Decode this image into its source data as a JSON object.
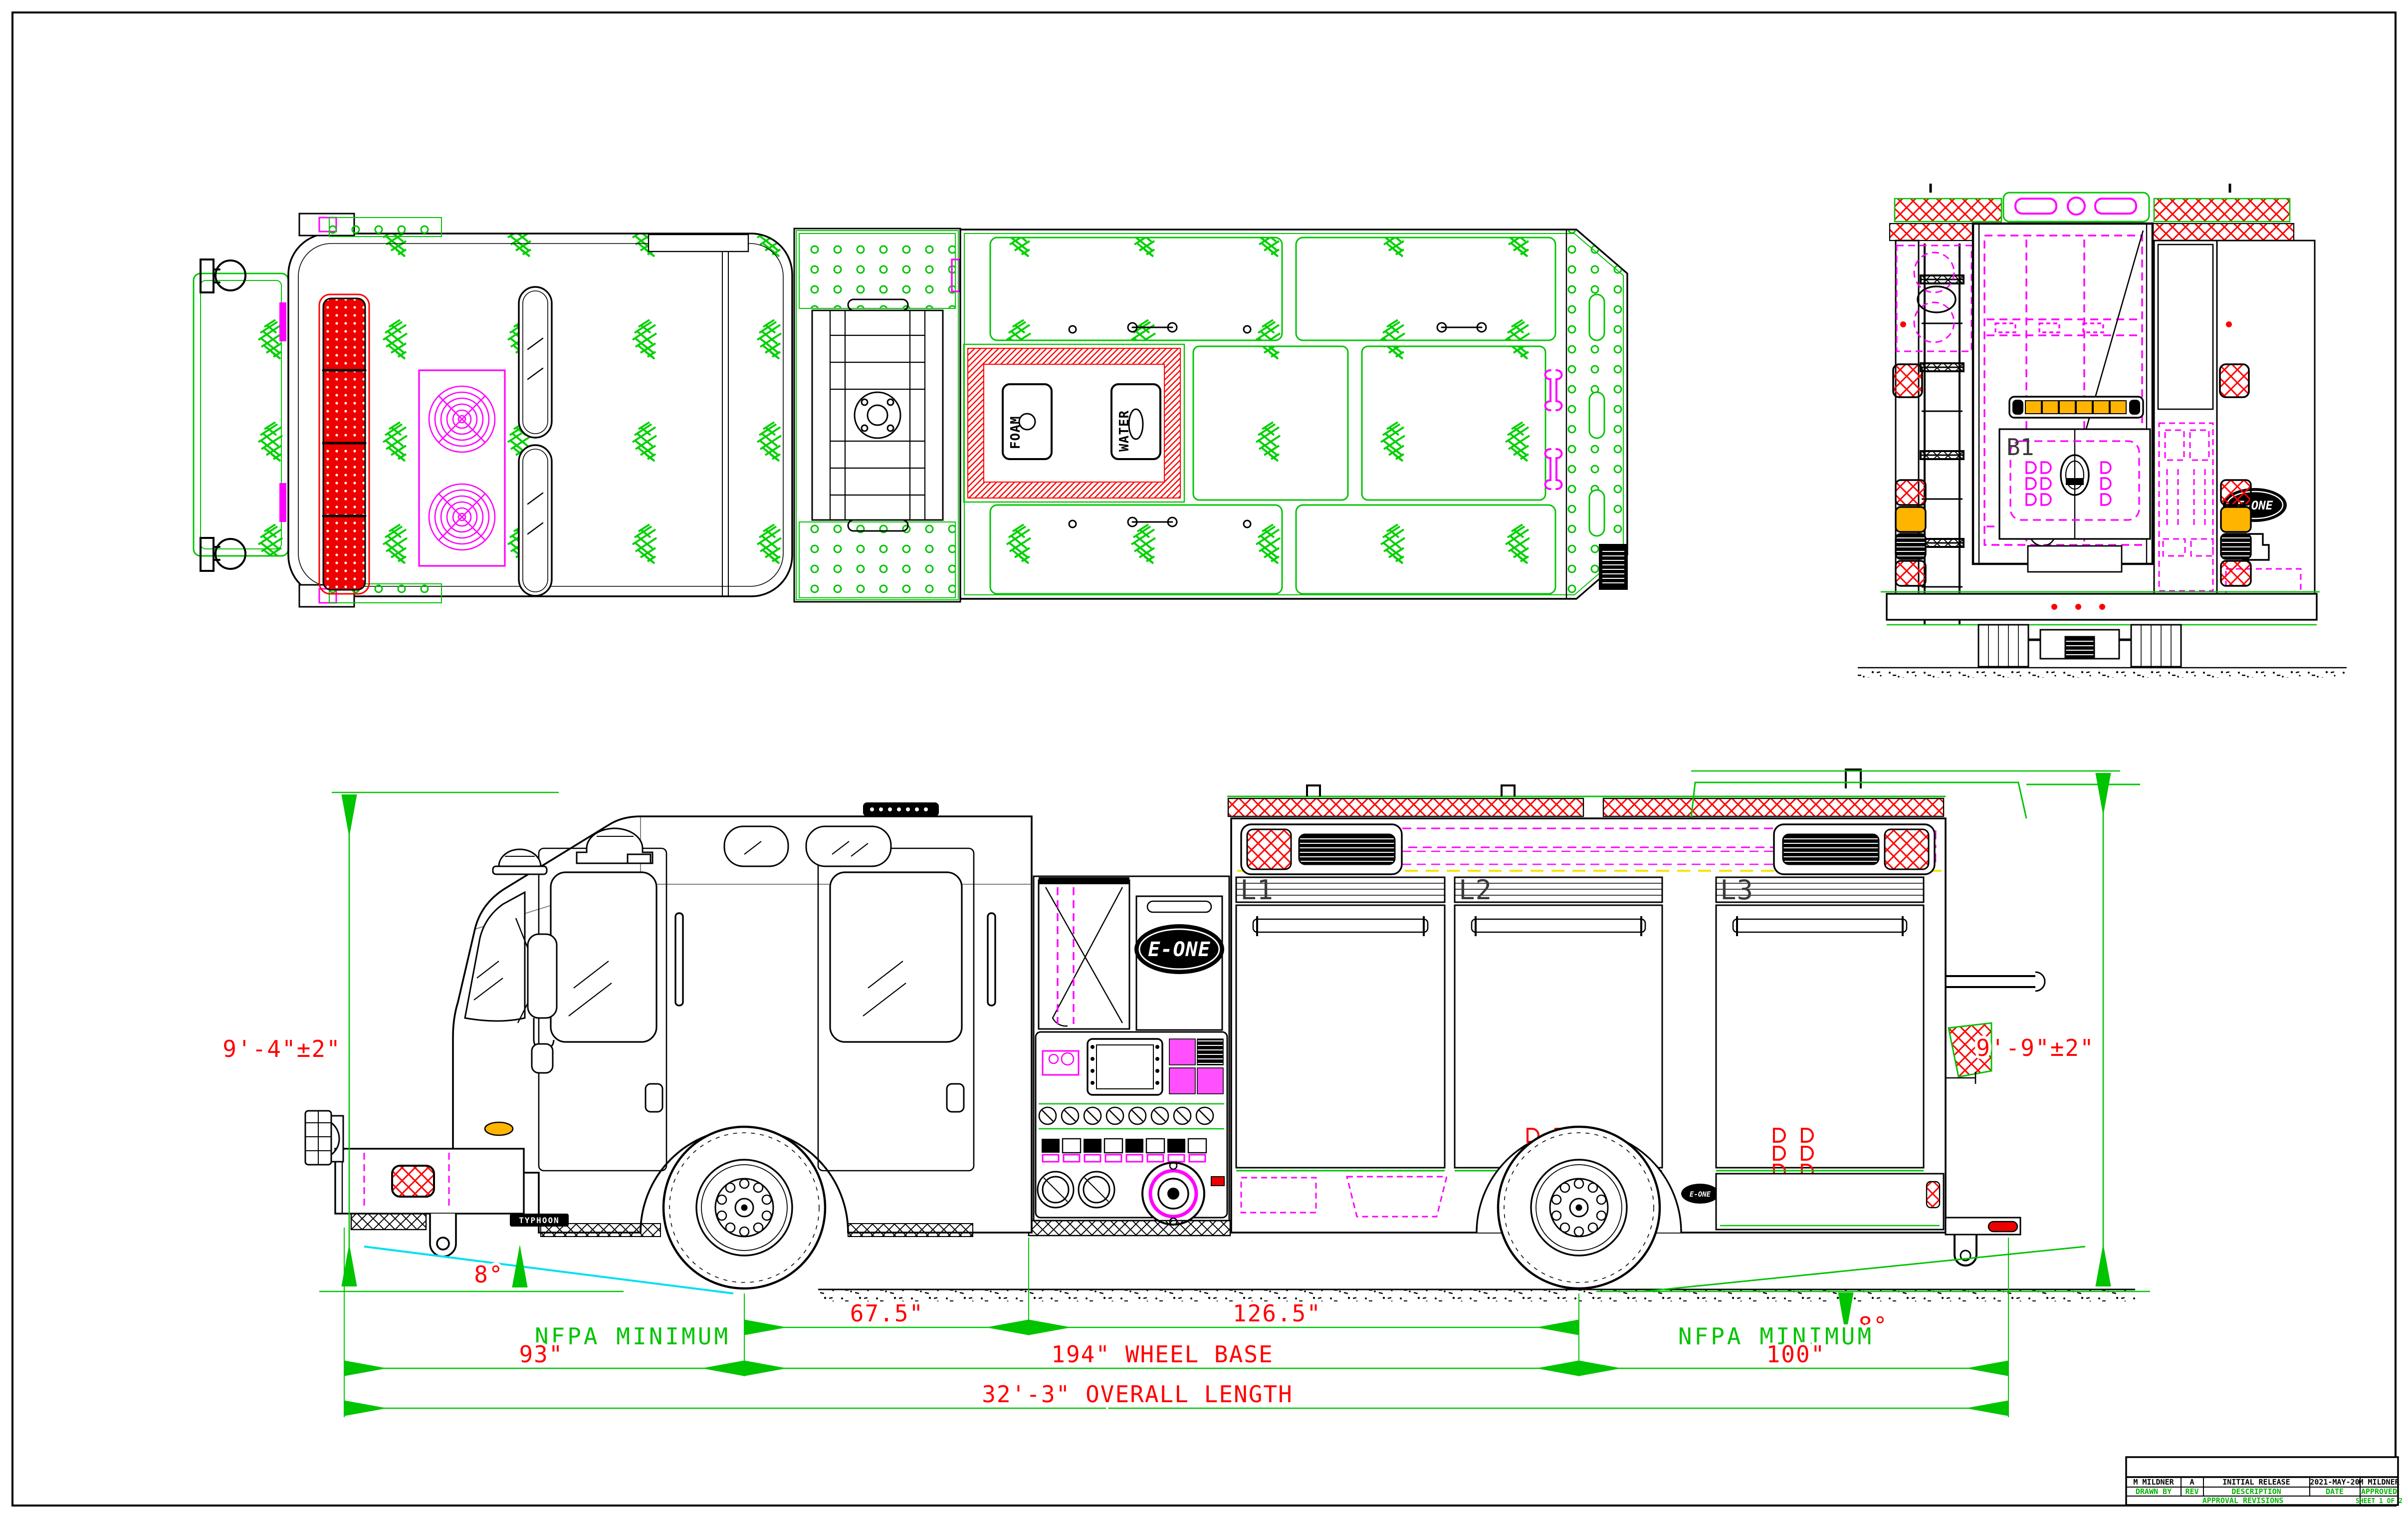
{
  "sheet": {
    "background": "#ffffff",
    "frame_color": "#000000",
    "line_color": "#000000",
    "annotation_green": "#00c400",
    "dimension_red": "#ff0000",
    "equipment_magenta": "#ff00ff",
    "angle_cyan": "#00e0f0",
    "reference_yellow": "#f5e400",
    "warning_amber": "#ffb400"
  },
  "views": {
    "top": "TOP VIEW",
    "rear": "REAR VIEW",
    "side": "SIDE VIEW"
  },
  "labels": {
    "brand": "E-ONE",
    "model": "TYPHOON",
    "door_l1": "L1",
    "door_l2": "L2",
    "door_l3": "L3",
    "compartment_b1": "B1",
    "fill_foam": "FOAM",
    "fill_water": "WATER"
  },
  "dimensions": {
    "height_front": "9'-4\"±2\"",
    "height_rear": "9'-9\"±2\"",
    "angle_approach": "8°",
    "angle_departure": "8°",
    "nfpa_front": "NFPA MINIMUM",
    "nfpa_rear": "NFPA MINIMUM",
    "axle_to_pump": "67.5\"",
    "pump_to_rear_axle": "126.5\"",
    "front_overhang": "93\"",
    "wheelbase": "194\" WHEEL BASE",
    "rear_overhang": "100\"",
    "overall_length": "32'-3\" OVERALL LENGTH"
  },
  "title_block": {
    "drawn_by_value": "M MILDNER",
    "rev_value": "A",
    "description_value": "INITIAL RELEASE",
    "date_value": "2021-MAY-20",
    "approved_value": "M MILDNER",
    "drawn_by_label": "DRAWN BY",
    "rev_label": "REV",
    "description_label": "DESCRIPTION",
    "date_label": "DATE",
    "approved_label": "APPROVED",
    "revisions_label": "APPROVAL REVISIONS",
    "sheet_label": "SHEET 1 OF 2"
  }
}
